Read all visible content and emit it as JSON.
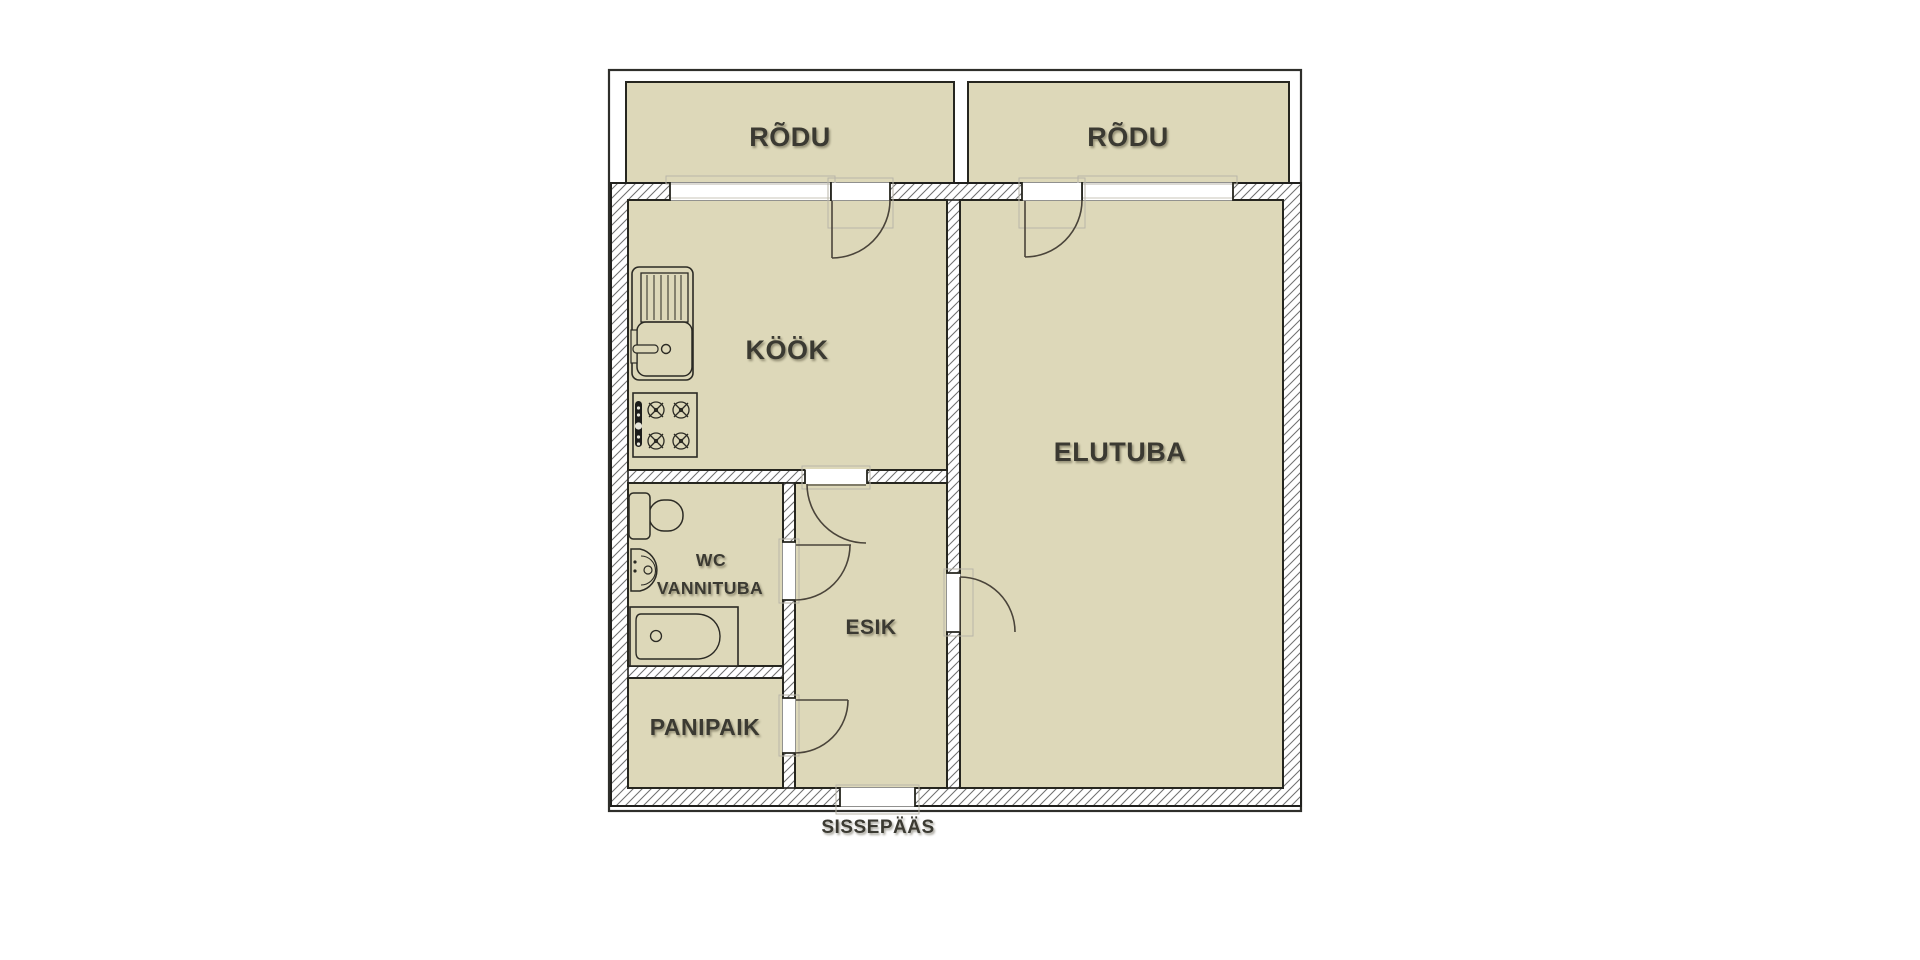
{
  "floorplan": {
    "type": "apartment-floor-plan",
    "labels": {
      "balcony_left": "RÕDU",
      "balcony_right": "RÕDU",
      "kitchen": "KÖÖK",
      "living_room": "ELUTUBA",
      "bathroom_line1": "WC",
      "bathroom_line2": "VANNITUBA",
      "hallway": "ESIK",
      "storage": "PANIPAIK",
      "entrance": "SISSEPÄÄS"
    },
    "colors": {
      "room_fill": "#ddd8b9",
      "wall_line": "#20201d",
      "hatch_line": "#6f6f6f",
      "label_text": "#3b3a32",
      "frame_line": "#b9b6a9",
      "background": "#ffffff"
    }
  }
}
